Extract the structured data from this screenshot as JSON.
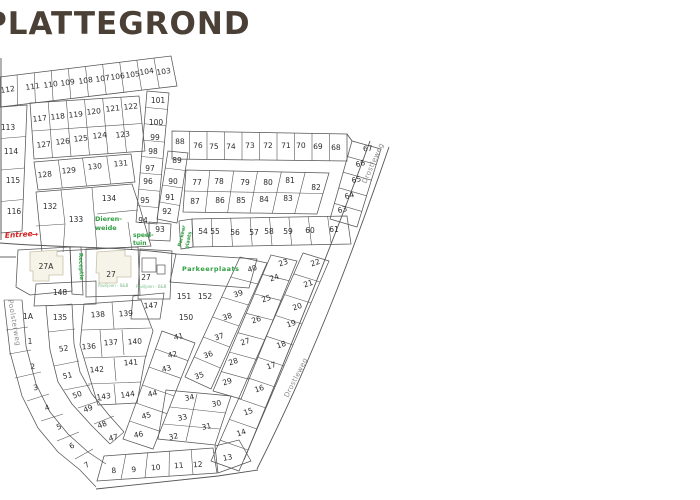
{
  "title": "PLATTEGROND",
  "map": {
    "streets": [
      "Drostleweg",
      "Drostleweg",
      "Poolsterweg"
    ],
    "entree": "Entree",
    "entree_arrow": "→",
    "green_labels": {
      "dierenweide": [
        "Dieren-",
        "weide"
      ],
      "speeltuin": [
        "speel-",
        "tuin"
      ],
      "receptie": "Receptie",
      "parkeerplaats": "Parkeerplaats",
      "parkeer_klein": [
        "Parkeer",
        "plaats"
      ],
      "paviljoen_1": "Paviljoen - B&B",
      "paviljoen_2": "Paviljoen - B&B"
    },
    "plots": [
      [
        "112",
        8,
        92,
        -8
      ],
      [
        "111",
        33,
        89,
        -8
      ],
      [
        "110",
        51,
        87,
        -8
      ],
      [
        "109",
        68,
        85,
        -8
      ],
      [
        "108",
        86,
        83,
        -8
      ],
      [
        "107",
        103,
        81,
        -8
      ],
      [
        "106",
        118,
        79,
        -8
      ],
      [
        "105",
        133,
        77,
        -8
      ],
      [
        "104",
        147,
        74,
        -8
      ],
      [
        "103",
        164,
        74,
        -8
      ],
      [
        "101",
        158,
        103,
        0
      ],
      [
        "100",
        156,
        125,
        0
      ],
      [
        "99",
        155,
        140,
        0
      ],
      [
        "98",
        153,
        154,
        0
      ],
      [
        "97",
        150,
        171,
        0
      ],
      [
        "96",
        148,
        184,
        0
      ],
      [
        "95",
        145,
        203,
        0
      ],
      [
        "94",
        143,
        223,
        0
      ],
      [
        "93",
        160,
        232,
        0
      ],
      [
        "113",
        8,
        130,
        0
      ],
      [
        "114",
        11,
        154,
        0
      ],
      [
        "115",
        13,
        183,
        0
      ],
      [
        "116",
        14,
        214,
        0
      ],
      [
        "117",
        40,
        121,
        -6
      ],
      [
        "118",
        58,
        119,
        -6
      ],
      [
        "119",
        76,
        117,
        -6
      ],
      [
        "120",
        94,
        114,
        -6
      ],
      [
        "121",
        113,
        111,
        -6
      ],
      [
        "122",
        131,
        109,
        -6
      ],
      [
        "127",
        44,
        147,
        -6
      ],
      [
        "126",
        63,
        144,
        -6
      ],
      [
        "125",
        81,
        141,
        -6
      ],
      [
        "124",
        100,
        138,
        -6
      ],
      [
        "123",
        123,
        137,
        -6
      ],
      [
        "128",
        45,
        177,
        -5
      ],
      [
        "129",
        69,
        173,
        -5
      ],
      [
        "130",
        95,
        169,
        -5
      ],
      [
        "131",
        121,
        166,
        -5
      ],
      [
        "132",
        50,
        209,
        0
      ],
      [
        "133",
        76,
        222,
        0
      ],
      [
        "134",
        109,
        201,
        0
      ],
      [
        "88",
        180,
        144,
        -2
      ],
      [
        "76",
        198,
        148,
        -2
      ],
      [
        "75",
        214,
        149,
        -2
      ],
      [
        "74",
        231,
        149,
        -2
      ],
      [
        "73",
        250,
        148,
        -2
      ],
      [
        "72",
        268,
        148,
        -2
      ],
      [
        "71",
        286,
        148,
        -2
      ],
      [
        "70",
        301,
        148,
        -2
      ],
      [
        "69",
        318,
        149,
        -2
      ],
      [
        "68",
        336,
        150,
        -2
      ],
      [
        "67",
        368,
        151,
        -5
      ],
      [
        "89",
        177,
        163,
        0
      ],
      [
        "90",
        173,
        184,
        0
      ],
      [
        "91",
        170,
        200,
        0
      ],
      [
        "92",
        167,
        214,
        0
      ],
      [
        "66",
        361,
        166,
        -15
      ],
      [
        "65",
        357,
        182,
        -15
      ],
      [
        "64",
        350,
        198,
        -15
      ],
      [
        "63",
        343,
        212,
        -15
      ],
      [
        "77",
        197,
        185,
        0
      ],
      [
        "78",
        219,
        184,
        0
      ],
      [
        "79",
        245,
        185,
        0
      ],
      [
        "80",
        268,
        185,
        0
      ],
      [
        "81",
        290,
        183,
        0
      ],
      [
        "82",
        316,
        190,
        0
      ],
      [
        "87",
        195,
        204,
        0
      ],
      [
        "86",
        220,
        203,
        0
      ],
      [
        "85",
        241,
        203,
        0
      ],
      [
        "84",
        264,
        202,
        0
      ],
      [
        "83",
        288,
        201,
        0
      ],
      [
        "54",
        203,
        234,
        0
      ],
      [
        "55",
        215,
        234,
        0
      ],
      [
        "56",
        235,
        235,
        0
      ],
      [
        "57",
        254,
        235,
        0
      ],
      [
        "58",
        269,
        234,
        0
      ],
      [
        "59",
        288,
        234,
        0
      ],
      [
        "60",
        310,
        233,
        0
      ],
      [
        "61",
        334,
        232,
        0
      ],
      [
        "27A",
        46,
        269,
        0
      ],
      [
        "27",
        111,
        277,
        0
      ],
      [
        "27",
        146,
        280,
        0
      ],
      [
        "148",
        60,
        295,
        0
      ],
      [
        "147",
        151,
        308,
        -3
      ],
      [
        "151",
        184,
        299,
        0
      ],
      [
        "152",
        205,
        299,
        0
      ],
      [
        "150",
        186,
        320,
        0
      ],
      [
        "1A",
        28,
        319,
        0
      ],
      [
        "135",
        60,
        320,
        0
      ],
      [
        "138",
        98,
        317,
        -4
      ],
      [
        "139",
        126,
        316,
        -4
      ],
      [
        "1",
        30,
        344,
        0
      ],
      [
        "52",
        64,
        351,
        -8
      ],
      [
        "136",
        89,
        349,
        -4
      ],
      [
        "137",
        111,
        345,
        -4
      ],
      [
        "140",
        135,
        344,
        -4
      ],
      [
        "2",
        33,
        369,
        -5
      ],
      [
        "51",
        68,
        378,
        -10
      ],
      [
        "142",
        97,
        372,
        -4
      ],
      [
        "141",
        131,
        365,
        -4
      ],
      [
        "3",
        36,
        390,
        -8
      ],
      [
        "50",
        78,
        397,
        -20
      ],
      [
        "143",
        104,
        399,
        -8
      ],
      [
        "144",
        128,
        397,
        -8
      ],
      [
        "4",
        48,
        410,
        -20
      ],
      [
        "49",
        89,
        411,
        -22
      ],
      [
        "45",
        147,
        418,
        -15
      ],
      [
        "41",
        179,
        339,
        -12
      ],
      [
        "42",
        173,
        357,
        -12
      ],
      [
        "43",
        167,
        371,
        -12
      ],
      [
        "44",
        153,
        396,
        -12
      ],
      [
        "46",
        139,
        437,
        -12
      ],
      [
        "40",
        253,
        271,
        -18
      ],
      [
        "39",
        239,
        296,
        -18
      ],
      [
        "38",
        228,
        319,
        -18
      ],
      [
        "37",
        220,
        339,
        -18
      ],
      [
        "36",
        209,
        357,
        -18
      ],
      [
        "35",
        200,
        378,
        -18
      ],
      [
        "23",
        284,
        265,
        -18
      ],
      [
        "24",
        275,
        280,
        -18
      ],
      [
        "25",
        267,
        301,
        -18
      ],
      [
        "26",
        257,
        322,
        -18
      ],
      [
        "27",
        246,
        344,
        -18
      ],
      [
        "28",
        234,
        364,
        -18
      ],
      [
        "29",
        228,
        384,
        -18
      ],
      [
        "22",
        316,
        265,
        -18
      ],
      [
        "21",
        309,
        286,
        -18
      ],
      [
        "20",
        298,
        309,
        -18
      ],
      [
        "19",
        292,
        326,
        -18
      ],
      [
        "18",
        282,
        347,
        -18
      ],
      [
        "17",
        272,
        368,
        -18
      ],
      [
        "16",
        260,
        391,
        -18
      ],
      [
        "15",
        249,
        414,
        -18
      ],
      [
        "14",
        242,
        435,
        -18
      ],
      [
        "13",
        228,
        460,
        -10
      ],
      [
        "34",
        190,
        400,
        -12
      ],
      [
        "33",
        183,
        420,
        -12
      ],
      [
        "32",
        174,
        439,
        -12
      ],
      [
        "30",
        217,
        406,
        -12
      ],
      [
        "31",
        207,
        429,
        -12
      ],
      [
        "5",
        60,
        429,
        -25
      ],
      [
        "48",
        103,
        427,
        -22
      ],
      [
        "47",
        114,
        440,
        -15
      ],
      [
        "6",
        73,
        448,
        -28
      ],
      [
        "7",
        88,
        467,
        -30
      ],
      [
        "8",
        114,
        473,
        -5
      ],
      [
        "9",
        134,
        472,
        -5
      ],
      [
        "10",
        156,
        470,
        -5
      ],
      [
        "11",
        179,
        468,
        -5
      ],
      [
        "12",
        198,
        467,
        -5
      ]
    ]
  },
  "colors": {
    "line": "#555555",
    "title": "#4b4036",
    "green": "#2e9e40",
    "red": "#d42020",
    "street": "#8c8c8c",
    "building_fill": "#f6f3e8",
    "building_stroke": "#c9c0a8"
  }
}
